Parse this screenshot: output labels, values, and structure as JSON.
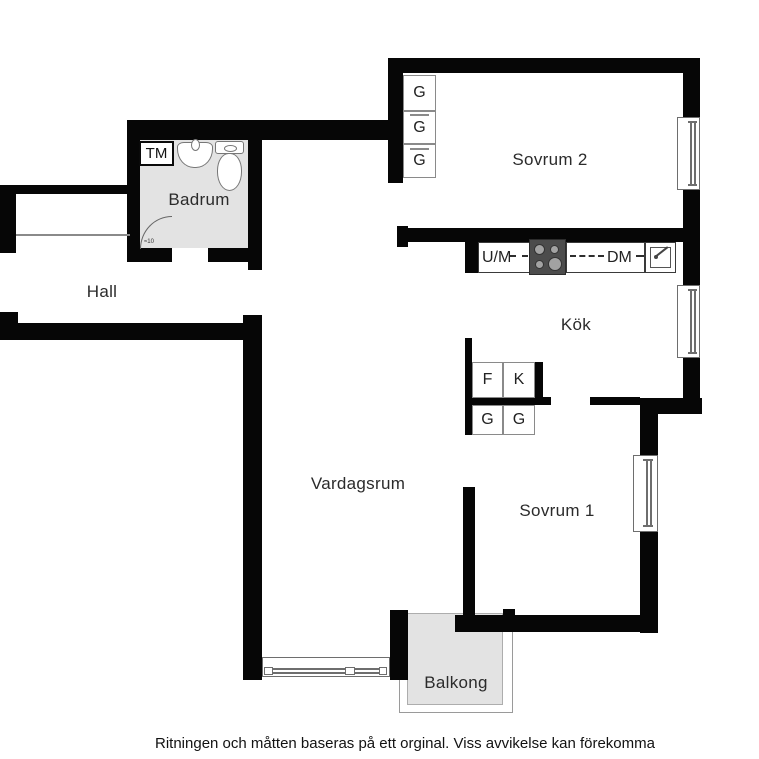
{
  "caption": "Ritningen och måtten baseras på ett orginal. Viss avvikelse kan förekomma",
  "rooms": {
    "hall": "Hall",
    "badrum": "Badrum",
    "sovrum2": "Sovrum 2",
    "kok": "Kök",
    "vardagsrum": "Vardagsrum",
    "sovrum1": "Sovrum 1",
    "balkong": "Balkong"
  },
  "appliances": {
    "washing_machine": "TM",
    "oven_micro": "U/M",
    "dishwasher": "DM",
    "door_note": "≈10"
  },
  "cabinets": {
    "sovrum2_closets": [
      "G",
      "G",
      "G"
    ],
    "kitchen_upper": [
      "F",
      "K"
    ],
    "kitchen_lower": [
      "G",
      "G"
    ]
  },
  "colors": {
    "wall": "#060606",
    "tile_floor": "#e3e3e3",
    "fixture_line": "#777777",
    "label_text": "#2b2b2b"
  }
}
